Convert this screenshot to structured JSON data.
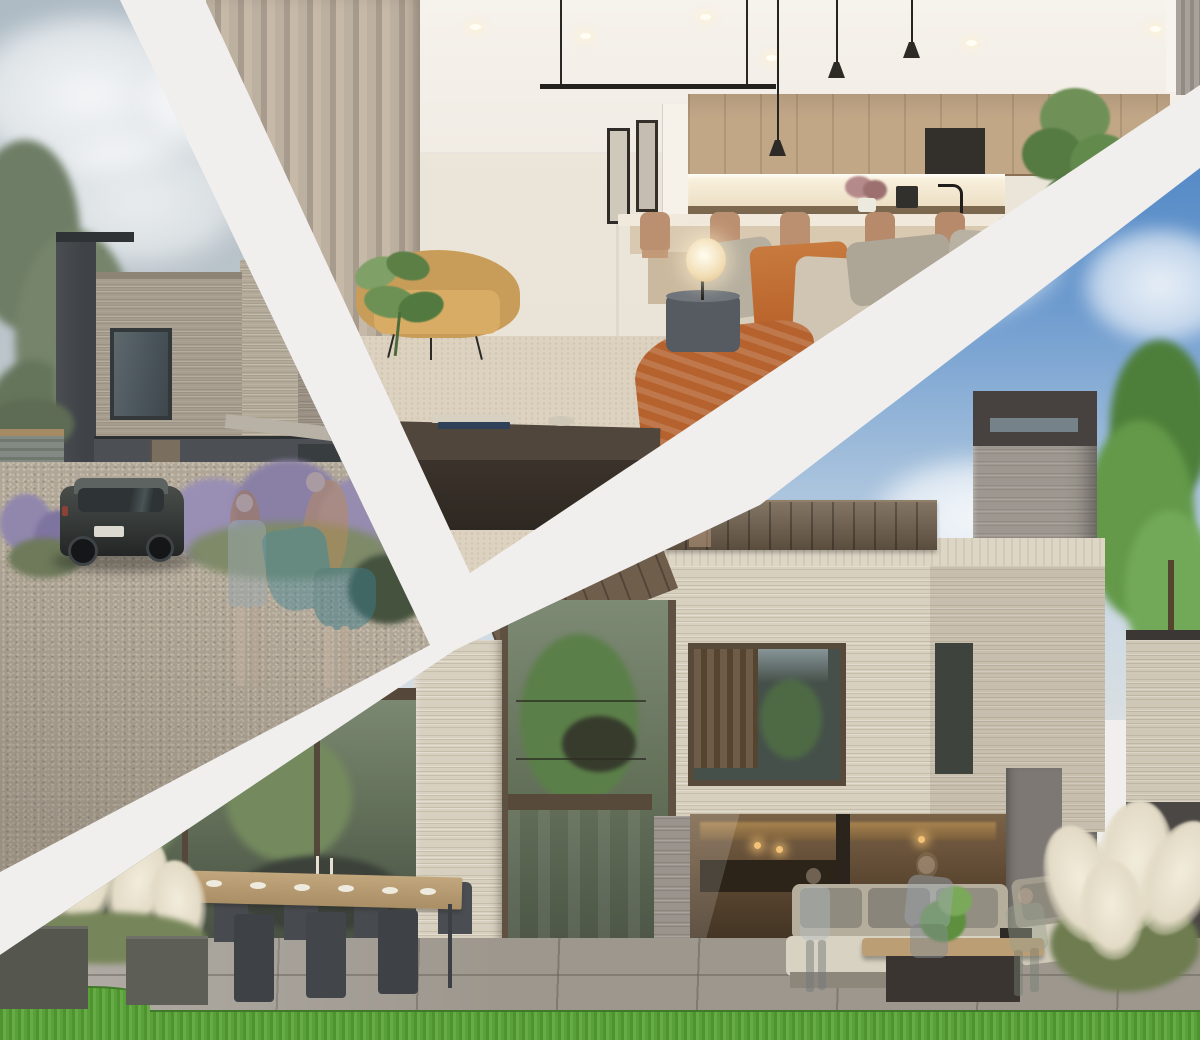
{
  "page": {
    "title": "New homes development — marketing photo collage",
    "canvas_width": 1200,
    "canvas_height": 1040,
    "divider_color": "#f0efed"
  },
  "collage": {
    "type": "three-photo diagonal collage",
    "scenes": {
      "street": {
        "name": "street-exterior-render",
        "description": "Exterior render of a dark contemporary brick house with a black car on a gravel driveway, pine tree, lavender planting, low fence and two translucent figures walking",
        "palette": {
          "sky": "#b2bfc8",
          "brick": "#a79d8e",
          "dark_cladding": "#4c4f54",
          "chimney": "#43464a",
          "gravel": "#b1a798",
          "lavender": "#9187ad",
          "car": "#3c403e",
          "fence_timber": "#a68a64"
        }
      },
      "interior": {
        "name": "living-kitchen-interior-render",
        "description": "Open-plan living room render with beige sofa, burnt-orange cushions and throw, mustard armchair, glowing table lamp, dark coffee table, timber kitchen wall units, island with bar stools and black pendant lights",
        "palette": {
          "ceiling": "#f5f1eb",
          "wall": "#ebe5da",
          "curtain": "#b0a396",
          "sofa": "#d3c9b7",
          "accent_orange": "#c06f36",
          "armchair_mustard": "#c89d59",
          "kitchen_timber": "#c2a787",
          "coffee_table": "#3b332b",
          "carpet": "#dcd2bf"
        }
      },
      "garden": {
        "name": "garden-exterior-render",
        "description": "Rear garden render of a cream brick house with bronze metal cladding, tall brick chimney, glazed double-height atrium, warm-lit interior, stone patio with outdoor dining table, lounge sofas, pampas grass planters, lawn and blue sky with clouds",
        "palette": {
          "sky_top": "#4a83c3",
          "sky_low": "#cdd9e4",
          "brick": "#d8d0bf",
          "bronze_cladding": "#6f5e4b",
          "chimney": "#9d9790",
          "window_frame": "#584a3b",
          "patio": "#9d978e",
          "lawn": "#5ba23e",
          "pampas": "#ece5d4",
          "interior_glow": "#a8834f"
        }
      }
    }
  }
}
